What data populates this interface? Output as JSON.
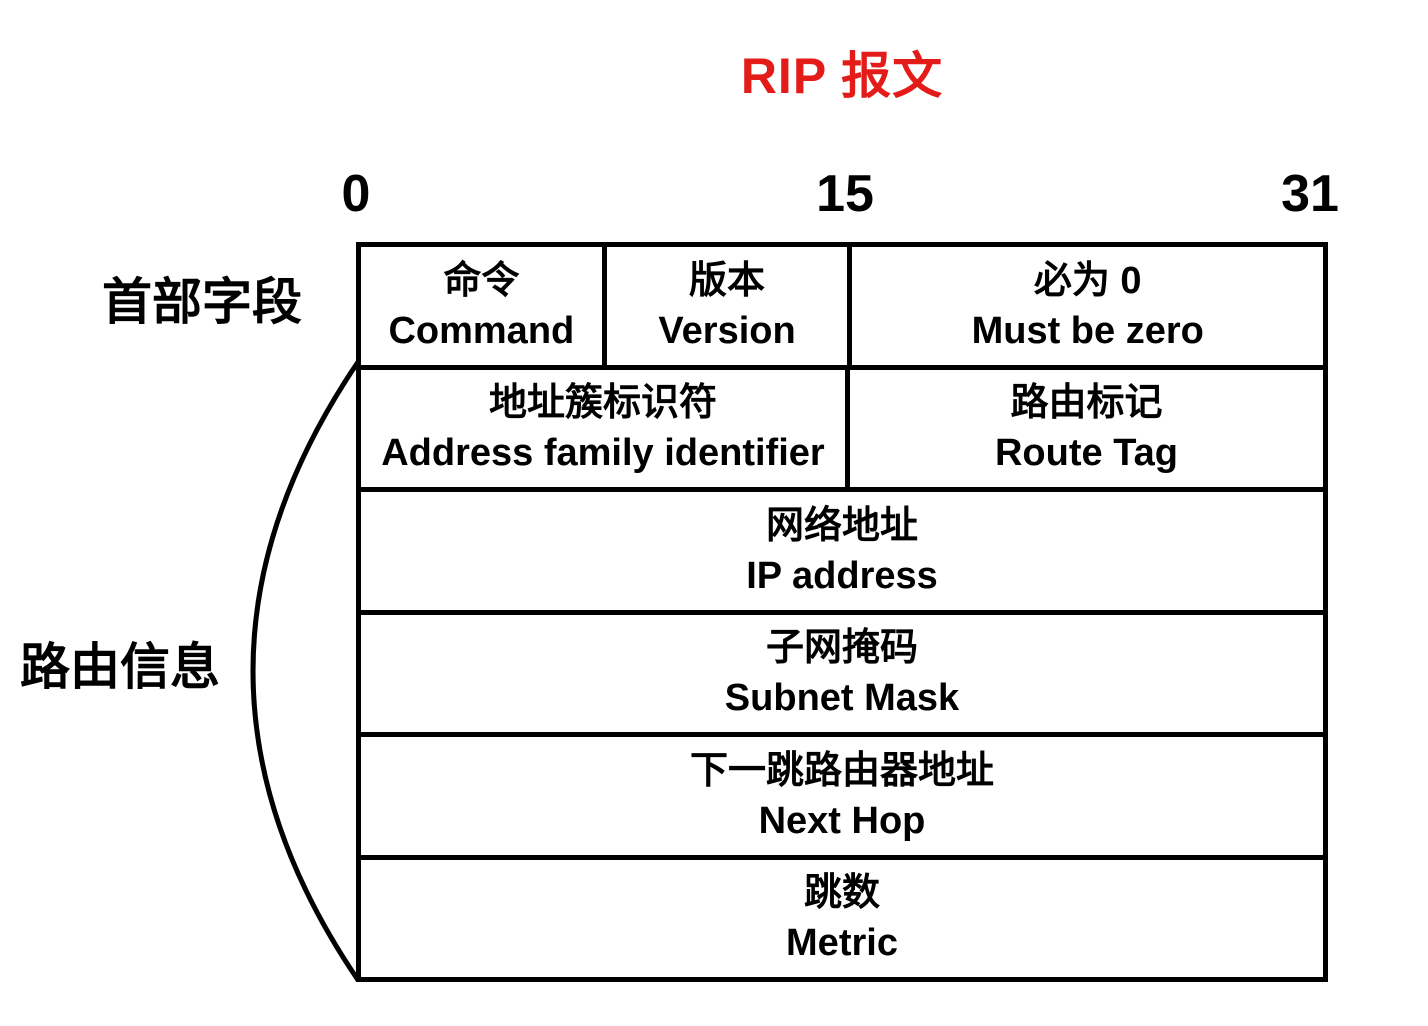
{
  "title": "RIP 报文",
  "colors": {
    "title": "#e31c1a",
    "line": "#000000",
    "background": "#ffffff"
  },
  "bit_scale": {
    "start": "0",
    "middle": "15",
    "end": "31"
  },
  "side_labels": {
    "header": "首部字段",
    "routing": "路由信息"
  },
  "table": {
    "rows": [
      {
        "cells": [
          {
            "zh": "命令",
            "en": "Command"
          },
          {
            "zh": "版本",
            "en": "Version"
          },
          {
            "zh": "必为 0",
            "en": "Must be zero"
          }
        ]
      },
      {
        "cells": [
          {
            "zh": "地址簇标识符",
            "en": "Address family identifier"
          },
          {
            "zh": "路由标记",
            "en": "Route Tag"
          }
        ]
      },
      {
        "cells": [
          {
            "zh": "网络地址",
            "en": "IP address"
          }
        ]
      },
      {
        "cells": [
          {
            "zh": "子网掩码",
            "en": "Subnet Mask"
          }
        ]
      },
      {
        "cells": [
          {
            "zh": "下一跳路由器地址",
            "en": "Next Hop"
          }
        ]
      },
      {
        "cells": [
          {
            "zh": "跳数",
            "en": "Metric"
          }
        ]
      }
    ]
  }
}
